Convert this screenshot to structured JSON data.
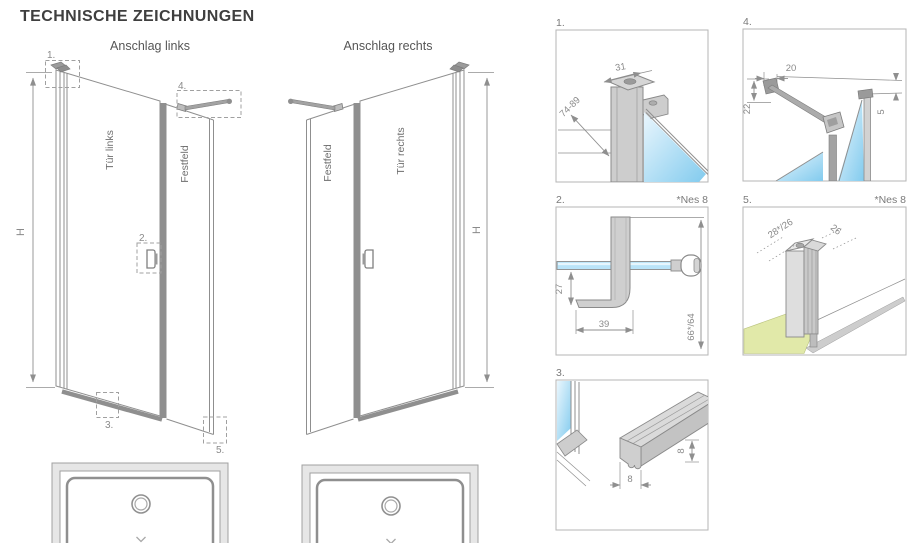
{
  "page": {
    "title": "TECHNISCHE ZEICHNUNGEN"
  },
  "drawings": {
    "left": {
      "subtitle": "Anschlag links",
      "door_label": "Tür links",
      "fixed_panel_label": "Festfeld",
      "height_label": "H",
      "callout_1": "1.",
      "callout_2": "2.",
      "callout_3": "3.",
      "callout_4": "4.",
      "callout_5": "5."
    },
    "right": {
      "subtitle": "Anschlag rechts",
      "door_label": "Tür rechts",
      "fixed_panel_label": "Festfeld",
      "height_label": "H"
    }
  },
  "details": {
    "d1": {
      "label": "1.",
      "dim_width": "31",
      "dim_range": "74-89"
    },
    "d2": {
      "label": "2.",
      "note": "*Nes 8",
      "dim_drop": "27",
      "dim_width": "39",
      "dim_height": "66*/64"
    },
    "d3": {
      "label": "3.",
      "dim_width": "8",
      "dim_height": "8"
    },
    "d4": {
      "label": "4.",
      "dim_top": "20",
      "dim_left": "22",
      "dim_right": "5"
    },
    "d5": {
      "label": "5.",
      "note": "*Nes 8",
      "dim_left": "28*/26",
      "dim_right": "26"
    }
  },
  "colors": {
    "title_text": "#3f3f3f",
    "line_gray": "#8f8f8f",
    "dim_text": "#8a8a8a",
    "glass_blue": "#82cbee",
    "glass_blue_light": "#eaf6fd",
    "floor_green": "#e1e9a9"
  }
}
